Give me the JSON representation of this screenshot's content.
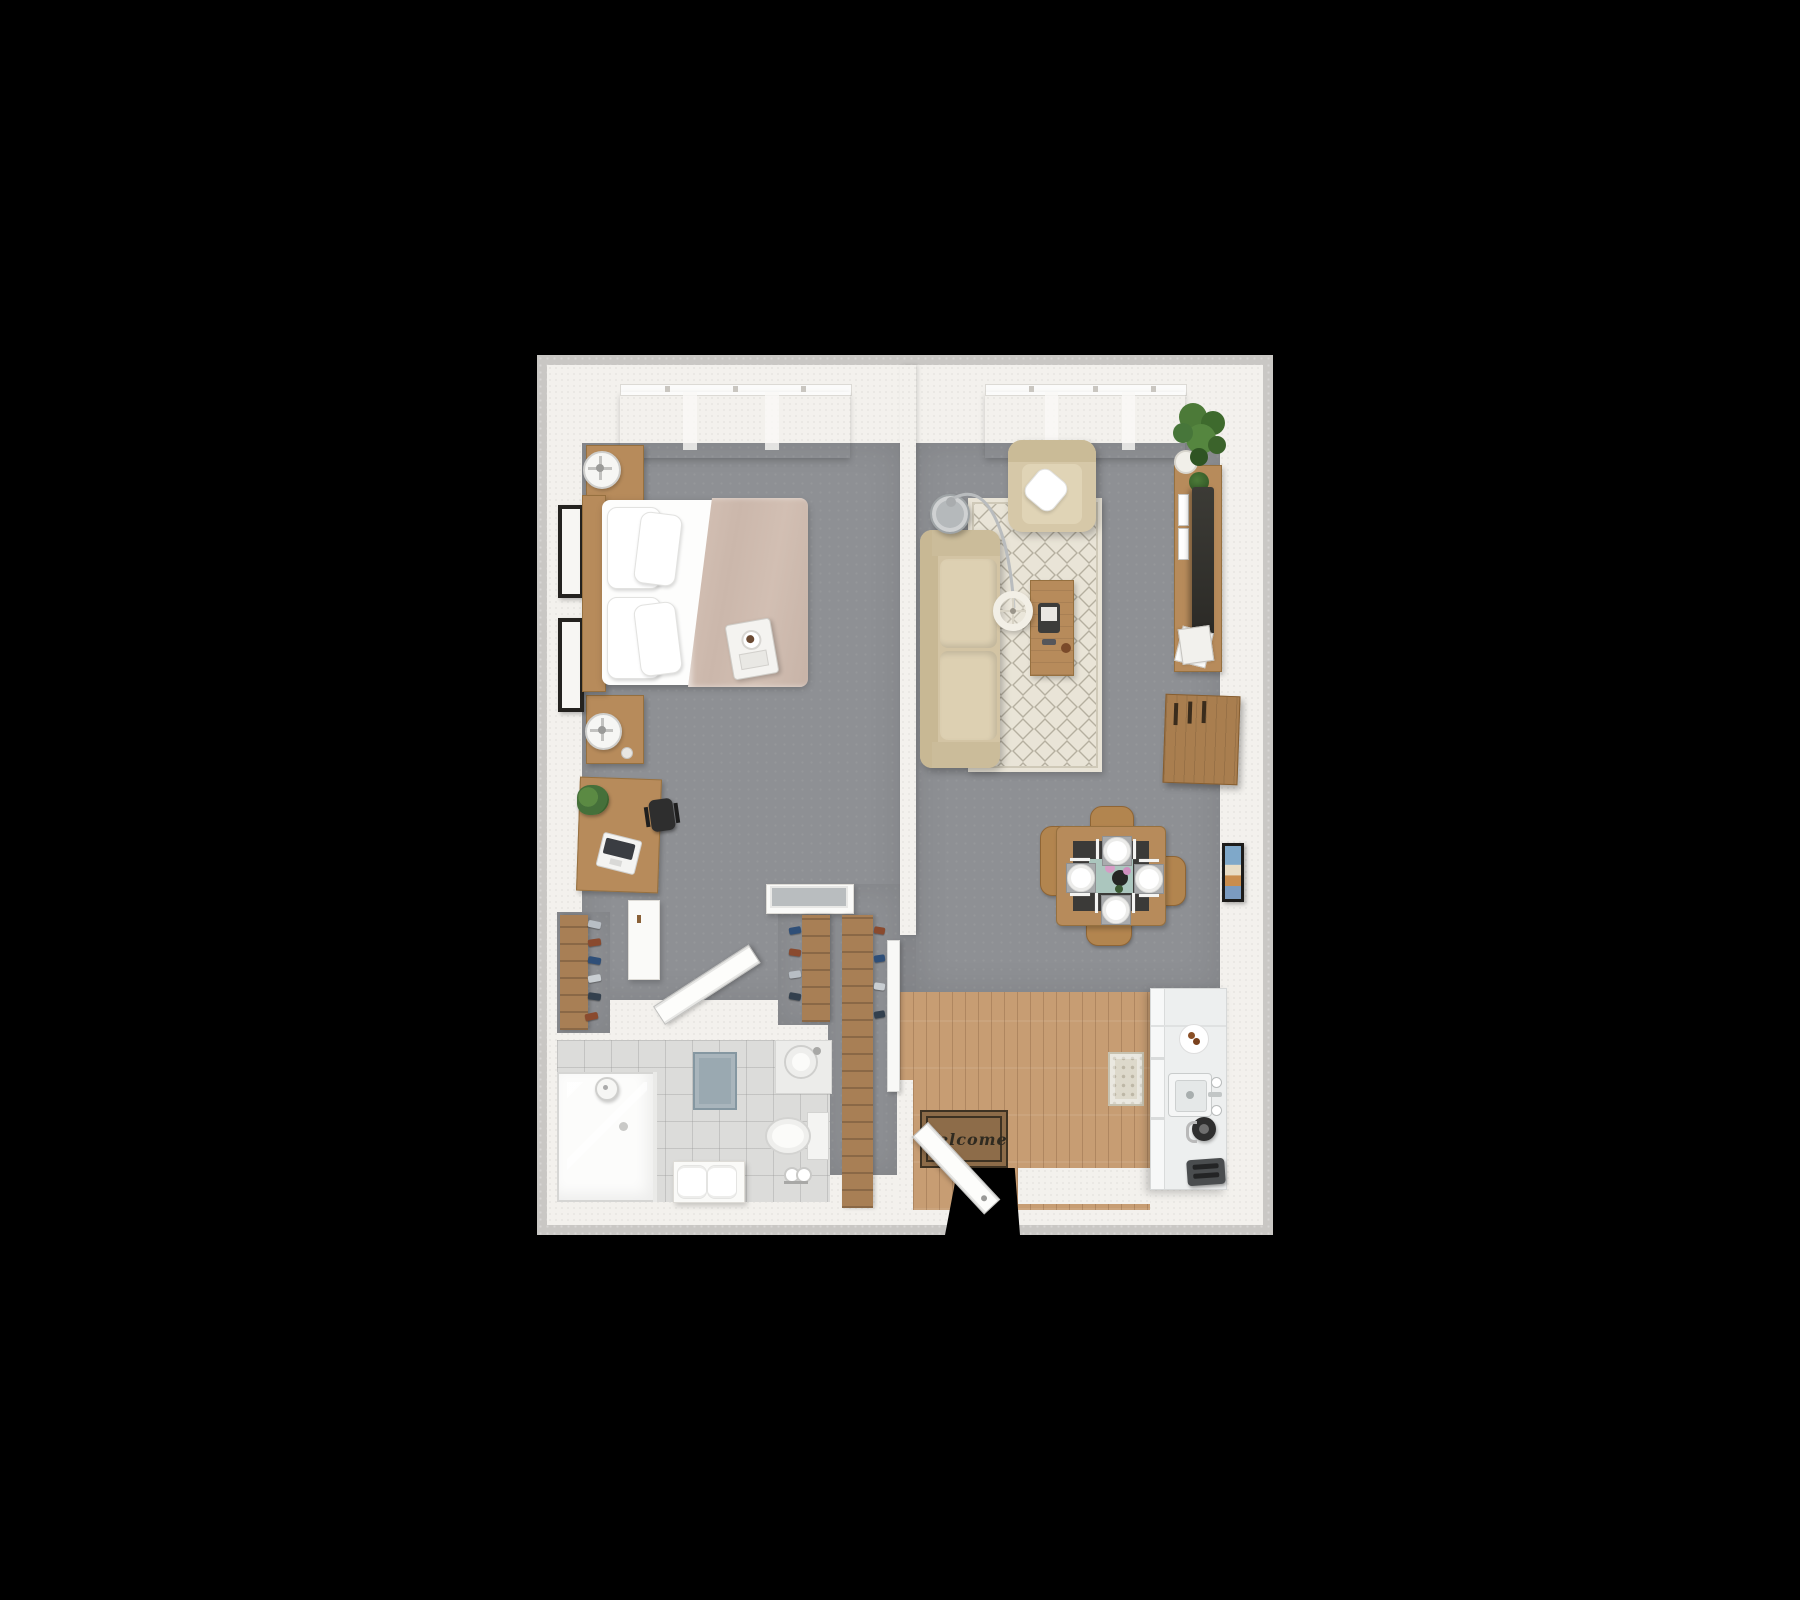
{
  "scene": {
    "type": "3d-floor-plan-top-view",
    "description": "Photorealistic top-down 3D rendering of a one-bedroom apartment floor plan centered on a black background",
    "background_color": "#000000"
  },
  "palette": {
    "walls": "#f3f1ed",
    "outer_edge": "#c9c7c4",
    "carpet_gray": "#8e9094",
    "wood_floor": "#c79d73",
    "wood_furniture": "#b78b5b",
    "upholstery_beige": "#d8caab",
    "rug_cream": "#e9e4d7",
    "bathroom_tile": "#dcdcda",
    "blanket_taupe": "#ccb8ab",
    "mat_brown": "#8d6c49",
    "tv_dark": "#35342f",
    "plant_green": "#4c7a38"
  },
  "rooms": [
    {
      "id": "bedroom",
      "name": "Bedroom",
      "floor": "gray carpet"
    },
    {
      "id": "living-room",
      "name": "Living / Dining Room",
      "floor": "gray carpet"
    },
    {
      "id": "kitchen",
      "name": "Kitchen",
      "floor": "wood plank"
    },
    {
      "id": "entry",
      "name": "Entry Hall",
      "floor": "wood plank"
    },
    {
      "id": "bathroom",
      "name": "Bathroom",
      "floor": "light tile"
    },
    {
      "id": "closet-hall",
      "name": "Closet Hallway",
      "floor": "gray carpet"
    }
  ],
  "furniture": {
    "bedroom": [
      "double bed with taupe duvet and four white pillows",
      "wooden headboard",
      "upper wooden nightstand with table fan",
      "lower wooden nightstand with table fan",
      "two black wall picture frames",
      "breakfast tray on bed",
      "wooden desk",
      "laptop",
      "potted desk plant",
      "black office chair",
      "white side cabinet",
      "closet shoe shelf"
    ],
    "living_room": [
      "beige fabric sofa",
      "beige armchair with white throw pillow",
      "cream diamond-pattern area rug",
      "wooden coffee table with tablet and remote",
      "round gray side table",
      "arc floor lamp",
      "white drum pendant shade",
      "wooden TV console",
      "flat screen TV",
      "magazine stack",
      "corner potted plant",
      "wooden storage cabinet",
      "framed wall art"
    ],
    "dining": [
      "square wooden dining table",
      "dark table top inlay",
      "mint table runner",
      "flower centerpiece vase",
      "four white place settings with cutlery",
      "four wooden dining chairs"
    ],
    "kitchen": [
      "white counter column with cabinets and fridge",
      "plate of cookies",
      "double-handle sink with faucet",
      "black electric kettle",
      "gray toaster",
      "patterned kitchen runner rug"
    ],
    "entry": [
      "brown welcome mat",
      "open white entry door",
      "tall wardrobe shoe shelf",
      "leaning mirror panel",
      "white cabinet with gray top"
    ],
    "bathroom": [
      "glass walk-in shower with rain head",
      "round countertop sink",
      "toilet with tank",
      "toilet paper stand",
      "white bench with two rolled towels",
      "blue-gray bath mat",
      "wall towel rail"
    ]
  },
  "windows": {
    "bedroom_curtains": "beige pleated curtains on white rail",
    "living_curtains": "beige pleated curtains on white rail"
  },
  "entry": {
    "mat_text": "Welcome"
  }
}
